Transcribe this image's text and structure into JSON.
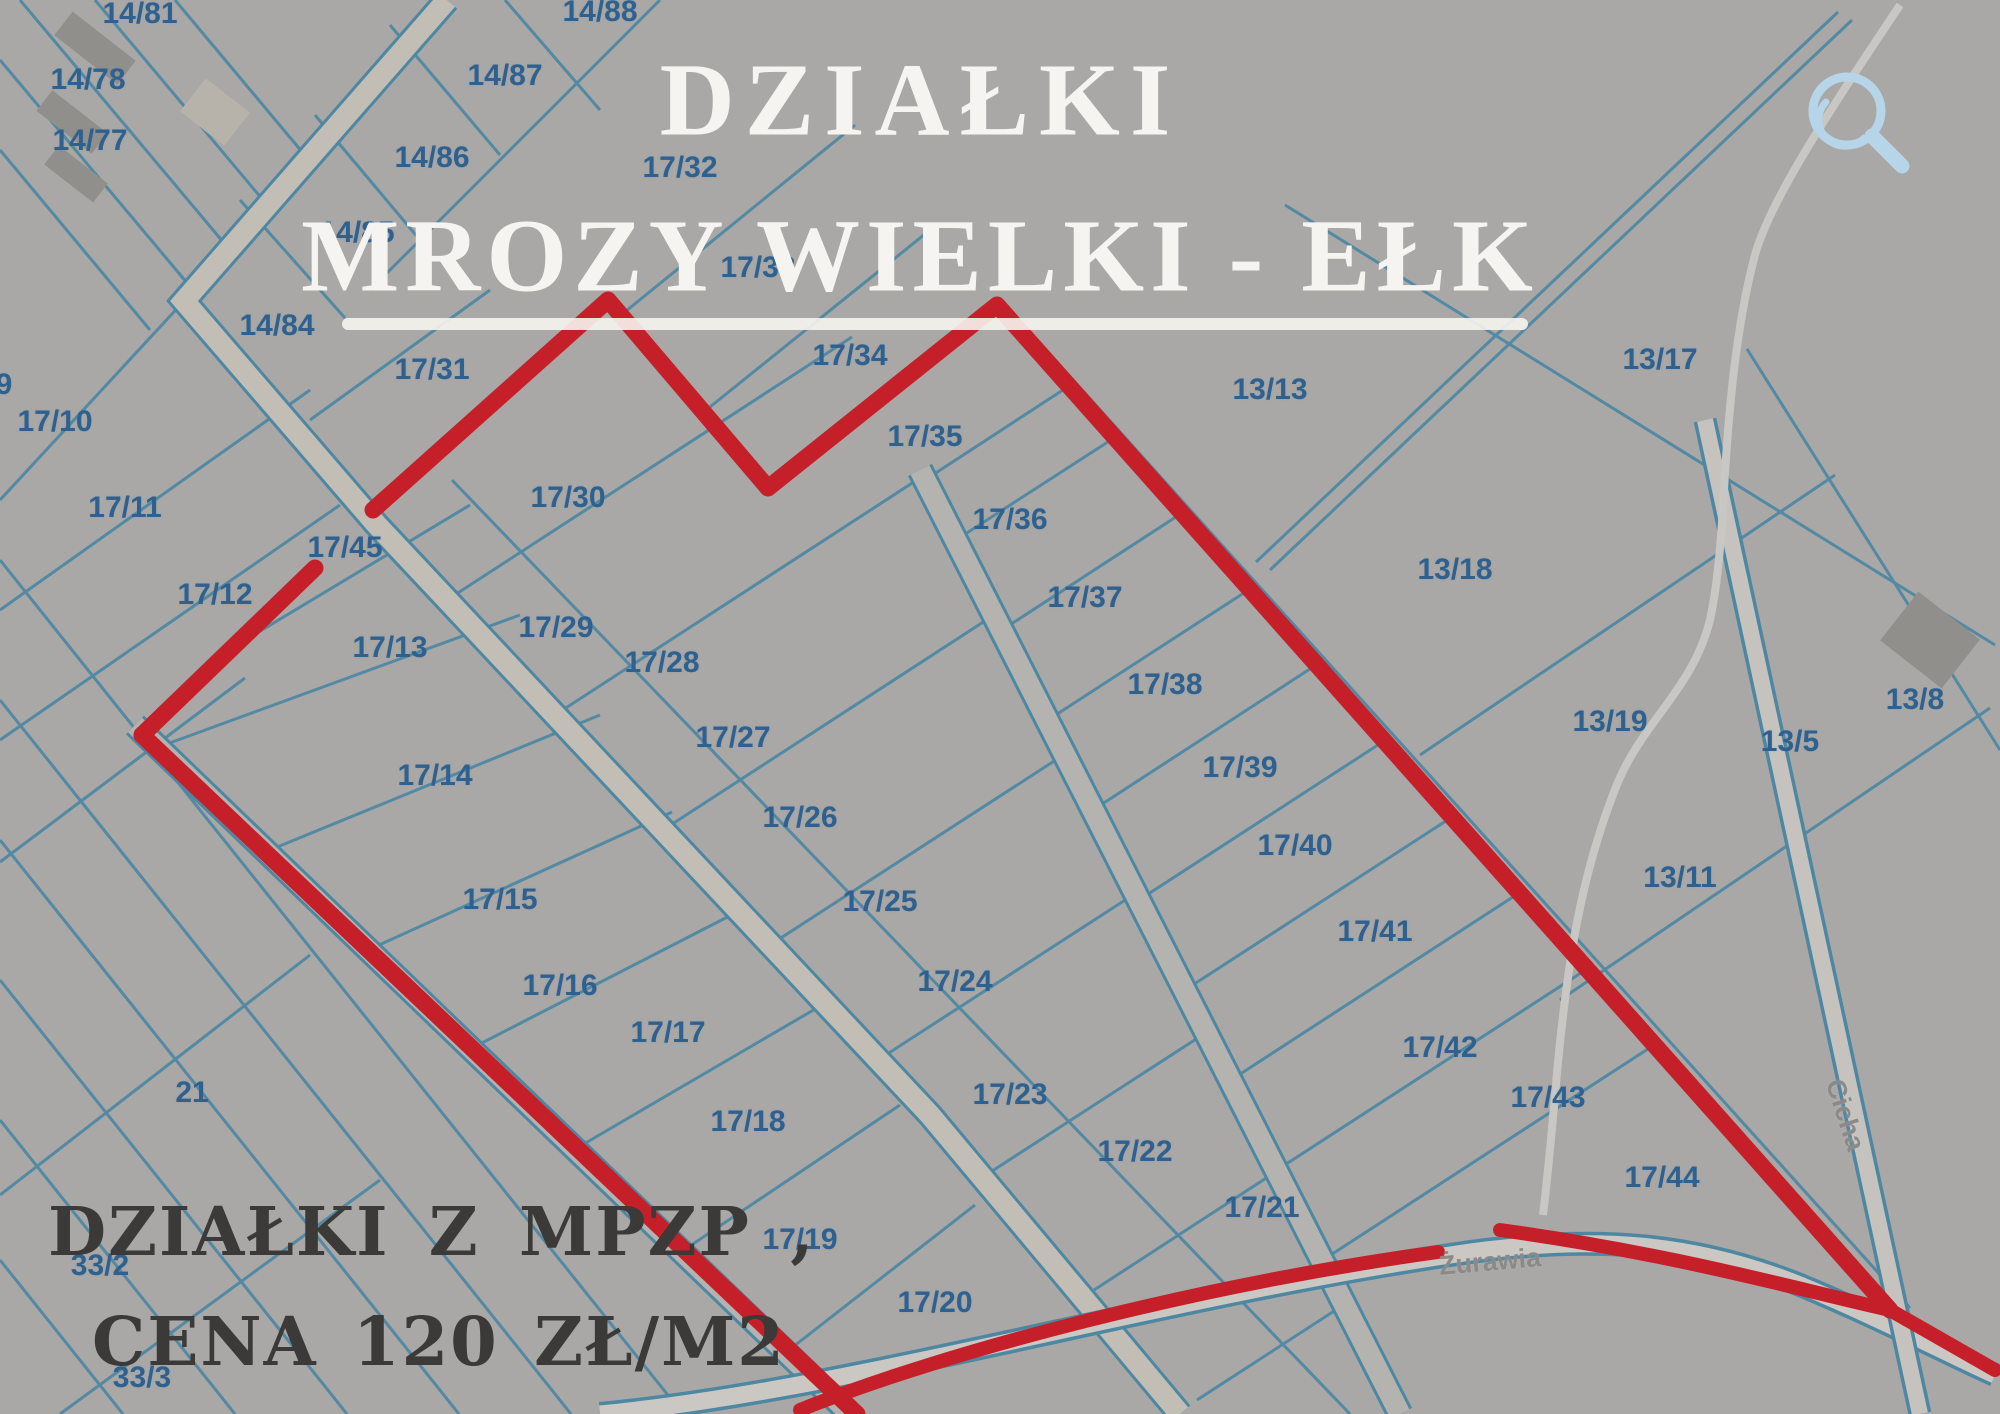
{
  "map": {
    "title_line1": "DZIAŁKI",
    "title_line2": "MROZY WIELKI - EŁK",
    "promo_line1": "DZIAŁKI  Z MPZP ,",
    "promo_line2": "CENA 120 ZŁ/M2",
    "streets": [
      {
        "name": "Żurawia",
        "x": 1490,
        "y": 1262,
        "rotation": -5
      },
      {
        "name": "Cicha",
        "x": 1845,
        "y": 1115,
        "rotation": 72
      }
    ],
    "icons": [
      {
        "name": "search-icon",
        "glyph": "magnifier",
        "color": "#b7d5e9"
      }
    ],
    "colors": {
      "background_gray": "#a9a8a6",
      "parcel_line_blue": "#4e87a2",
      "label_blue": "#2f6190",
      "boundary_red": "#c5202a",
      "title_white": "#f6f4f0",
      "promo_dark": "#3b3a38",
      "street_label_gray": "#8b8a88",
      "magnifier_blue": "#b7d5e9"
    },
    "parcels": [
      {
        "id": "9",
        "x": 4,
        "y": 385
      },
      {
        "id": "14/81",
        "x": 140,
        "y": 14
      },
      {
        "id": "14/78",
        "x": 88,
        "y": 80
      },
      {
        "id": "14/77",
        "x": 90,
        "y": 141
      },
      {
        "id": "14/88",
        "x": 600,
        "y": 12
      },
      {
        "id": "14/87",
        "x": 505,
        "y": 76
      },
      {
        "id": "14/86",
        "x": 432,
        "y": 158
      },
      {
        "id": "14/85",
        "x": 357,
        "y": 233
      },
      {
        "id": "14/84",
        "x": 277,
        "y": 326
      },
      {
        "id": "17/32",
        "x": 680,
        "y": 168
      },
      {
        "id": "17/33",
        "x": 758,
        "y": 268
      },
      {
        "id": "17/31",
        "x": 432,
        "y": 370
      },
      {
        "id": "17/34",
        "x": 850,
        "y": 356
      },
      {
        "id": "17/35",
        "x": 925,
        "y": 437
      },
      {
        "id": "17/30",
        "x": 568,
        "y": 498
      },
      {
        "id": "17/36",
        "x": 1010,
        "y": 520
      },
      {
        "id": "13/13",
        "x": 1270,
        "y": 390
      },
      {
        "id": "13/17",
        "x": 1660,
        "y": 360
      },
      {
        "id": "17/10",
        "x": 55,
        "y": 422
      },
      {
        "id": "17/11",
        "x": 125,
        "y": 508
      },
      {
        "id": "17/45",
        "x": 345,
        "y": 548
      },
      {
        "id": "17/12",
        "x": 215,
        "y": 595
      },
      {
        "id": "17/13",
        "x": 390,
        "y": 648
      },
      {
        "id": "17/29",
        "x": 556,
        "y": 628
      },
      {
        "id": "17/28",
        "x": 662,
        "y": 663
      },
      {
        "id": "17/37",
        "x": 1085,
        "y": 598
      },
      {
        "id": "13/18",
        "x": 1455,
        "y": 570
      },
      {
        "id": "17/27",
        "x": 733,
        "y": 738
      },
      {
        "id": "17/38",
        "x": 1165,
        "y": 685
      },
      {
        "id": "17/14",
        "x": 435,
        "y": 776
      },
      {
        "id": "13/19",
        "x": 1610,
        "y": 722
      },
      {
        "id": "13/8",
        "x": 1915,
        "y": 700
      },
      {
        "id": "13/5",
        "x": 1790,
        "y": 742
      },
      {
        "id": "17/26",
        "x": 800,
        "y": 818
      },
      {
        "id": "17/39",
        "x": 1240,
        "y": 768
      },
      {
        "id": "17/40",
        "x": 1295,
        "y": 846
      },
      {
        "id": "13/11",
        "x": 1680,
        "y": 878
      },
      {
        "id": "17/15",
        "x": 500,
        "y": 900
      },
      {
        "id": "17/25",
        "x": 880,
        "y": 902
      },
      {
        "id": "17/41",
        "x": 1375,
        "y": 932
      },
      {
        "id": "17/16",
        "x": 560,
        "y": 986
      },
      {
        "id": "17/24",
        "x": 955,
        "y": 982
      },
      {
        "id": "17/17",
        "x": 668,
        "y": 1033
      },
      {
        "id": "17/42",
        "x": 1440,
        "y": 1048
      },
      {
        "id": "21",
        "x": 192,
        "y": 1093
      },
      {
        "id": "17/23",
        "x": 1010,
        "y": 1095
      },
      {
        "id": "17/43",
        "x": 1548,
        "y": 1098
      },
      {
        "id": "17/18",
        "x": 748,
        "y": 1122
      },
      {
        "id": "17/22",
        "x": 1135,
        "y": 1152
      },
      {
        "id": "17/44",
        "x": 1662,
        "y": 1178
      },
      {
        "id": "17/21",
        "x": 1262,
        "y": 1208
      },
      {
        "id": "33/2",
        "x": 100,
        "y": 1266
      },
      {
        "id": "17/19",
        "x": 800,
        "y": 1240
      },
      {
        "id": "17/20",
        "x": 935,
        "y": 1303
      },
      {
        "id": "33/3",
        "x": 142,
        "y": 1378
      }
    ]
  }
}
